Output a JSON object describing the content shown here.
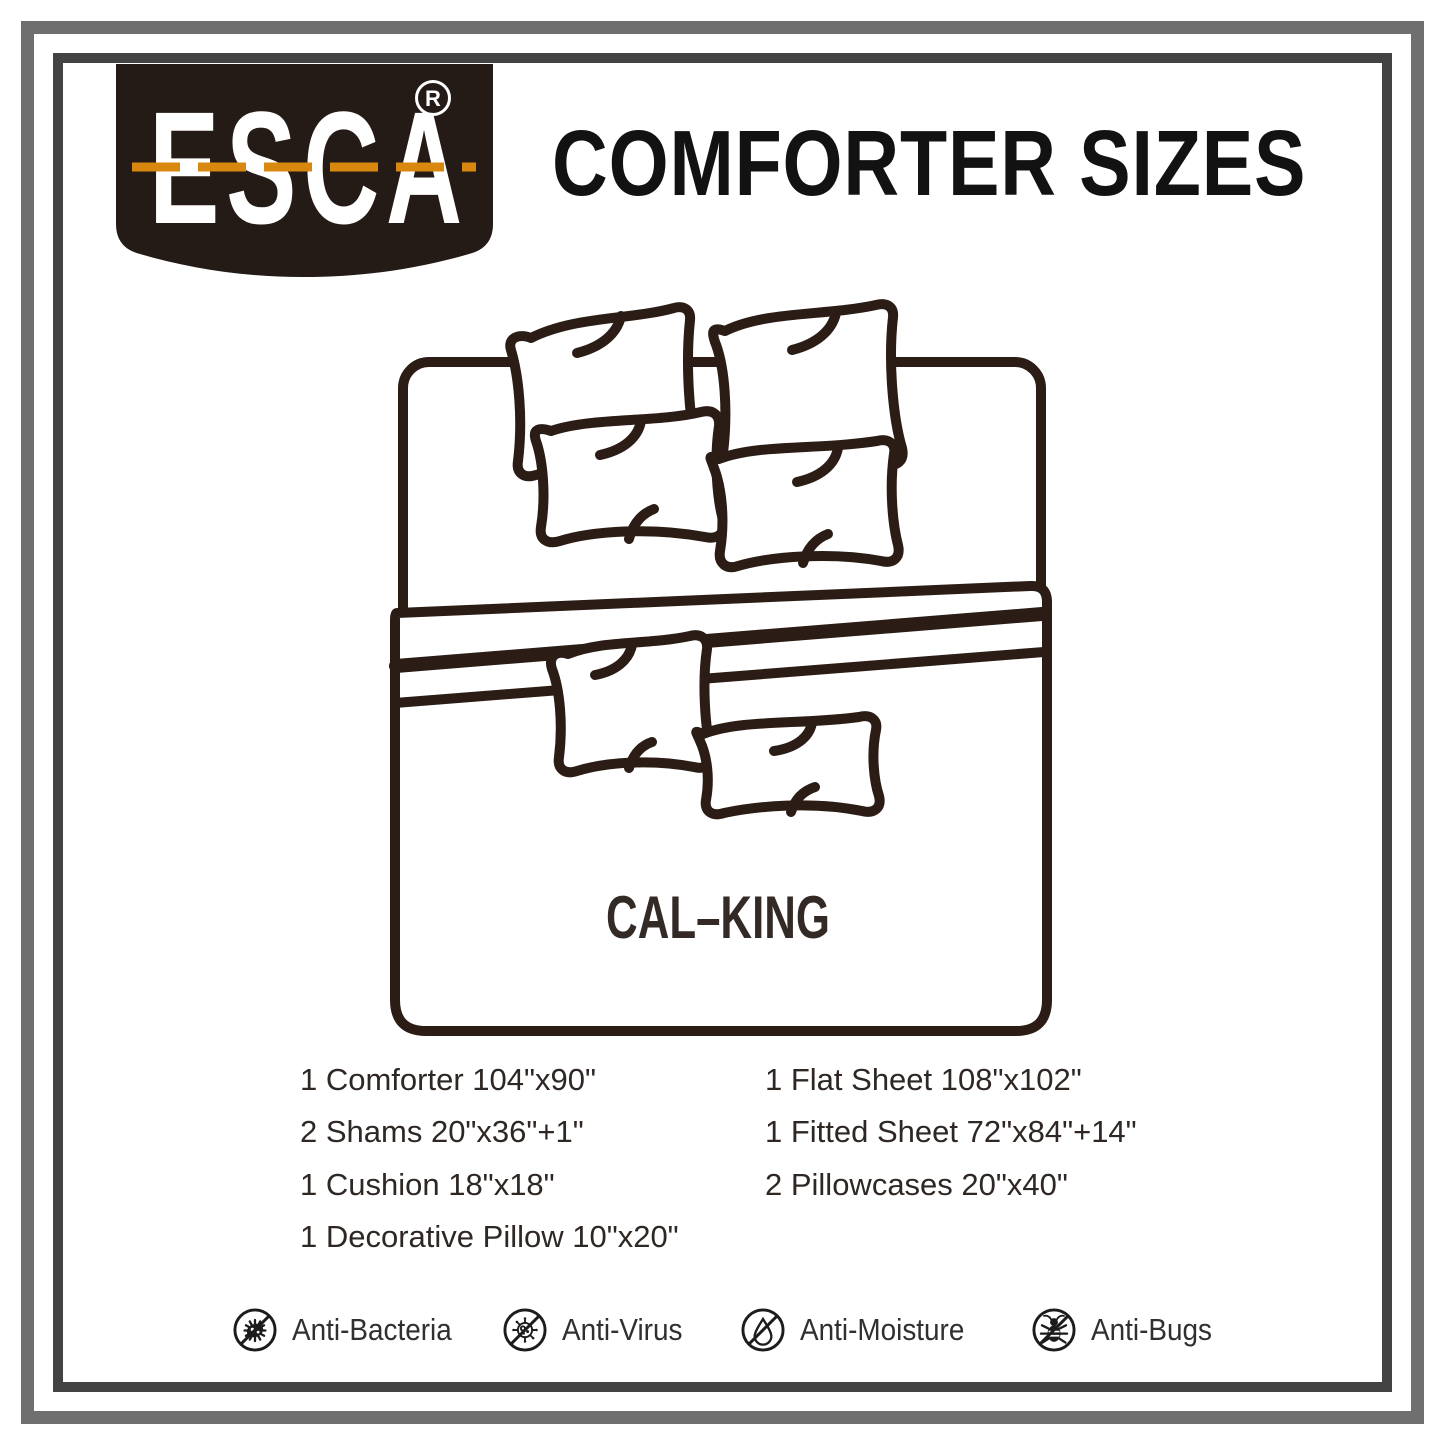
{
  "brand": {
    "name": "ESCA",
    "registered_mark": "R"
  },
  "title": "COMFORTER SIZES",
  "diagram": {
    "size_label": "CAL–KING"
  },
  "contents": {
    "left_column": [
      "1 Comforter 104\"x90\"",
      "2 Shams 20\"x36\"+1\"",
      "1 Cushion 18\"x18\"",
      "1 Decorative Pillow 10\"x20\""
    ],
    "right_column": [
      "1 Flat Sheet 108\"x102\"",
      "1 Fitted Sheet 72\"x84\"+14\"",
      "2 Pillowcases 20\"x40\""
    ]
  },
  "features": [
    {
      "icon": "anti-bacteria-icon",
      "label": "Anti-Bacteria"
    },
    {
      "icon": "anti-virus-icon",
      "label": "Anti-Virus"
    },
    {
      "icon": "anti-moisture-icon",
      "label": "Anti-Moisture"
    },
    {
      "icon": "anti-bugs-icon",
      "label": "Anti-Bugs"
    }
  ],
  "colors": {
    "accent_orange": "#d9880f",
    "badge_brown": "#251b16",
    "line_art": "#2b1d15",
    "frame_outer_gray": "#6f6f6f",
    "frame_inner_gray": "#434343"
  }
}
